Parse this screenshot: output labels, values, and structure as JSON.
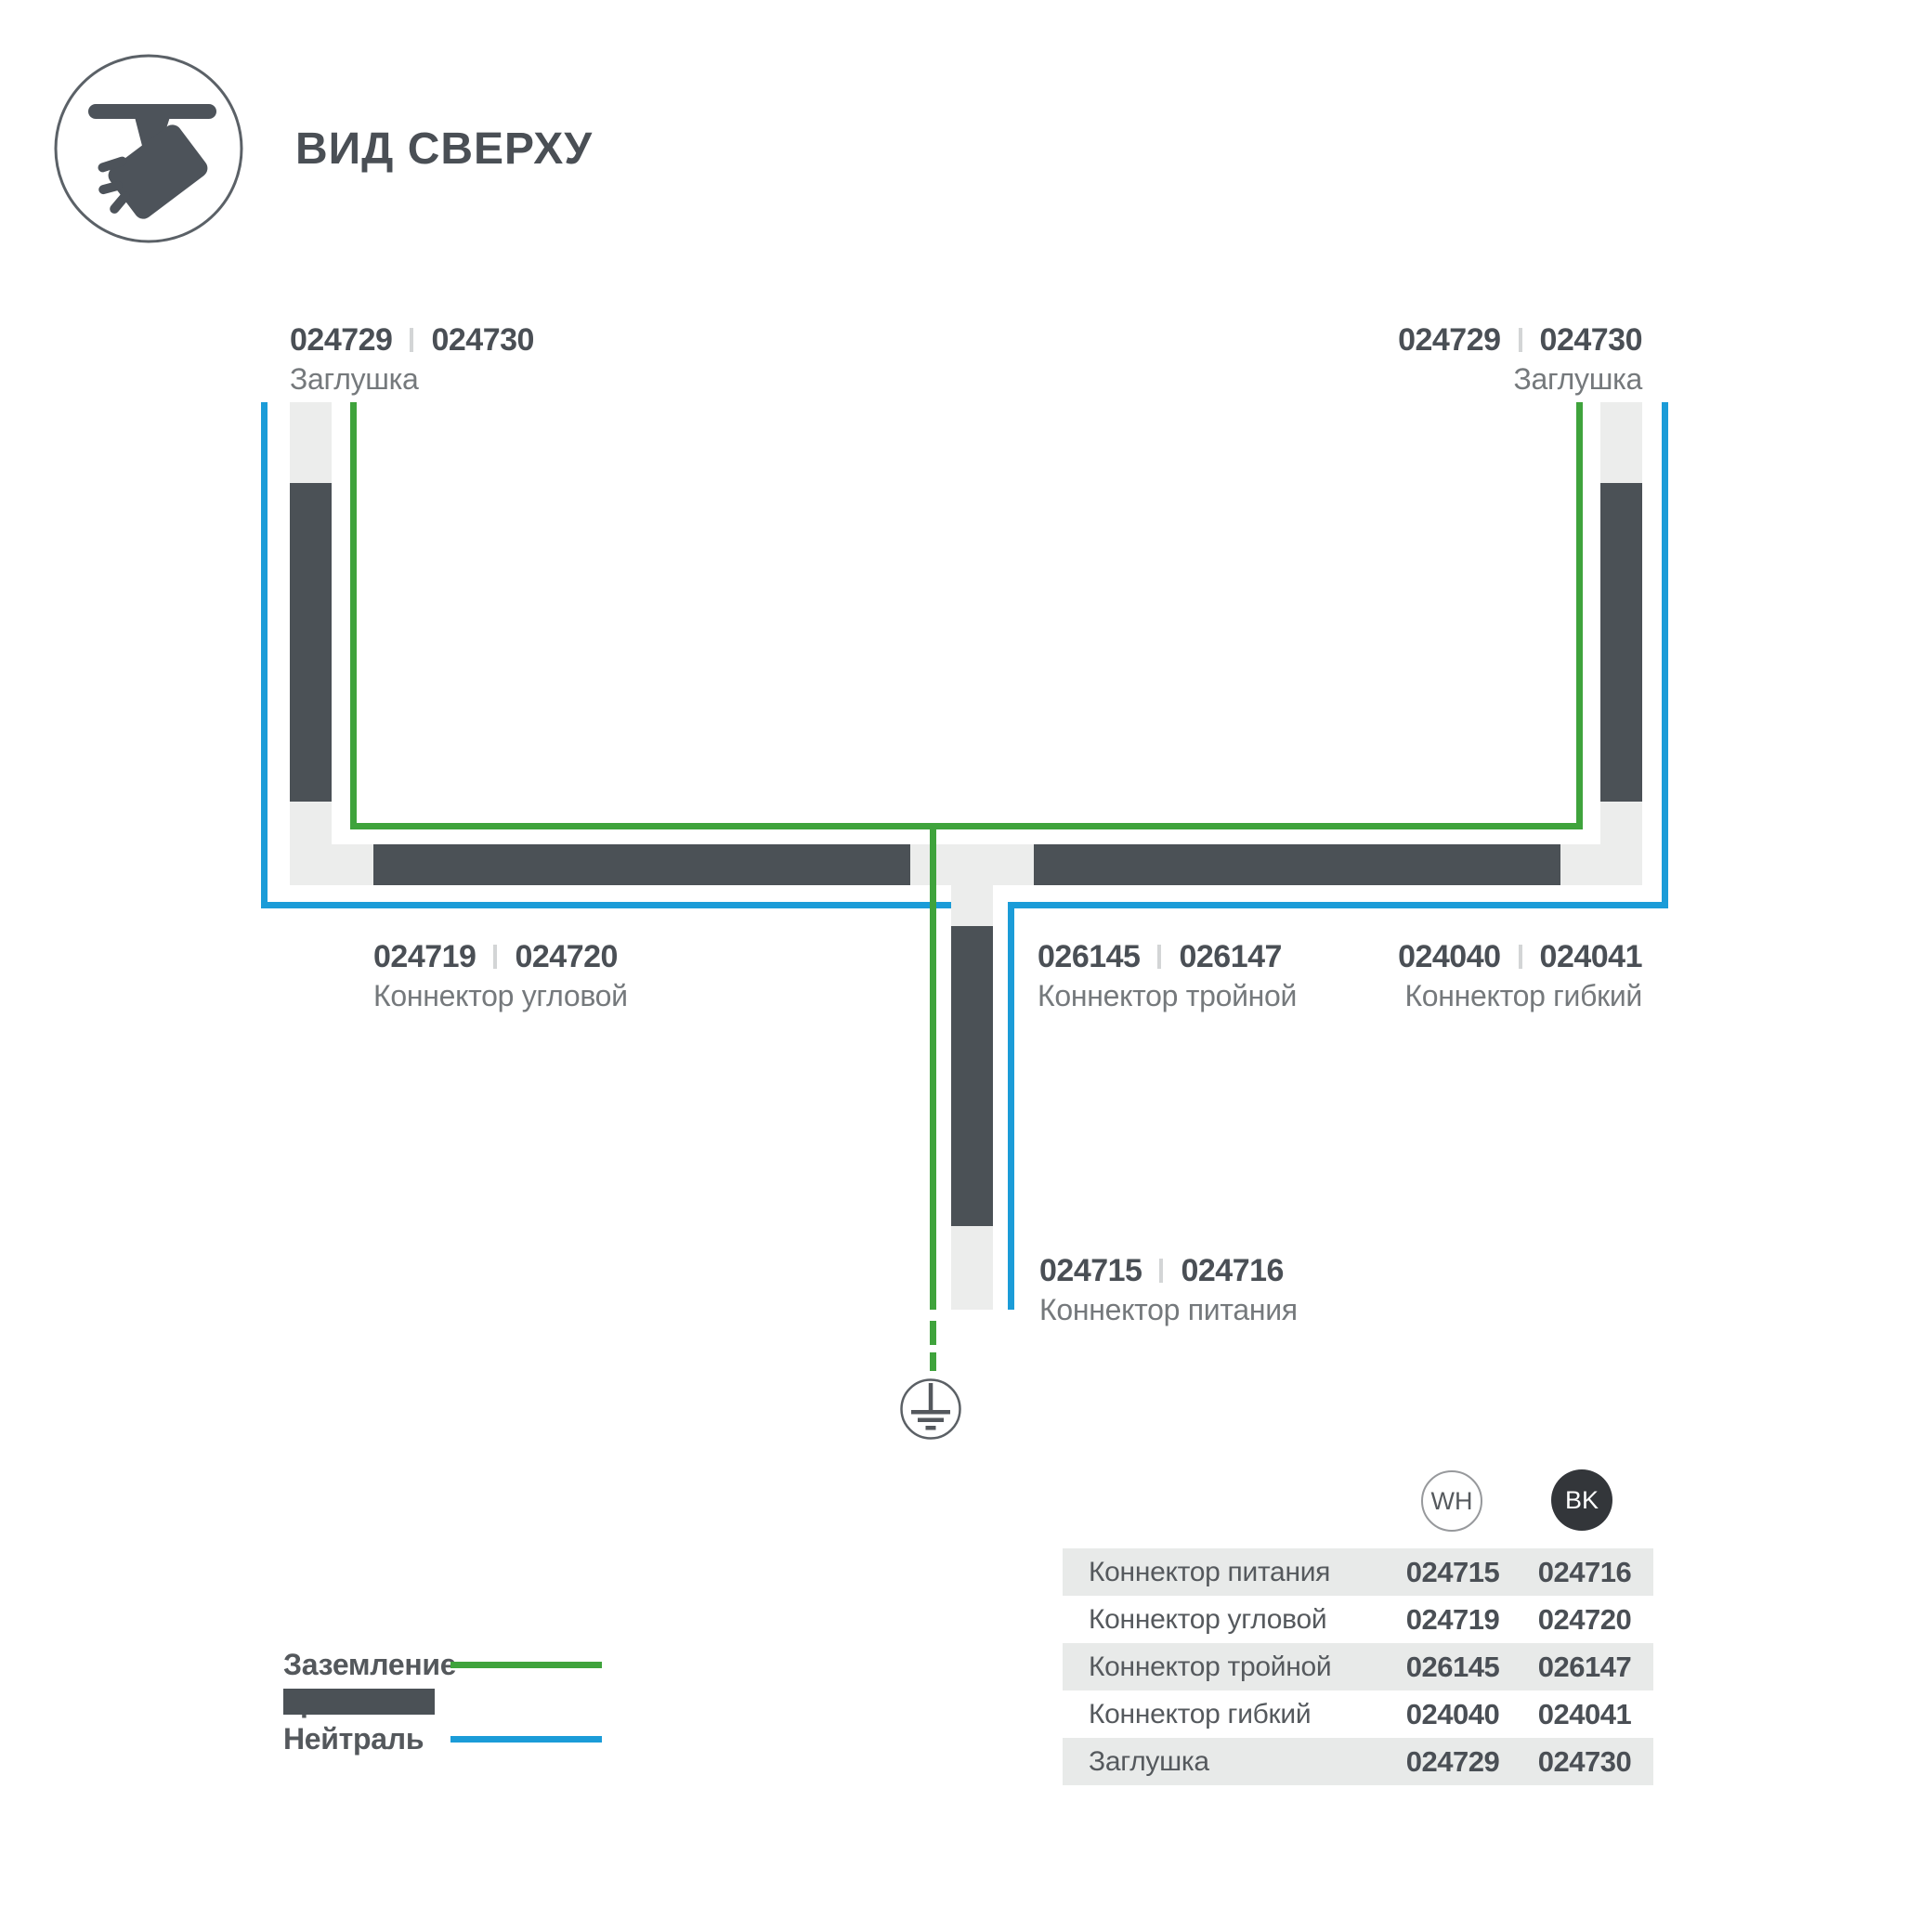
{
  "header": {
    "title": "ВИД СВЕРХУ"
  },
  "labels": {
    "cap_left": {
      "wh": "024729",
      "bk": "024730",
      "name": "Заглушка"
    },
    "cap_right": {
      "wh": "024729",
      "bk": "024730",
      "name": "Заглушка"
    },
    "corner": {
      "wh": "024719",
      "bk": "024720",
      "name": "Коннектор угловой"
    },
    "triple": {
      "wh": "026145",
      "bk": "026147",
      "name": "Коннектор тройной"
    },
    "flexible": {
      "wh": "024040",
      "bk": "024041",
      "name": "Коннектор гибкий"
    },
    "power": {
      "wh": "024715",
      "bk": "024716",
      "name": "Коннектор питания"
    }
  },
  "legend": {
    "ground": "Заземление",
    "track": "Трек",
    "neutral": "Нейтраль"
  },
  "table": {
    "columns": {
      "wh": "WH",
      "bk": "BK"
    },
    "rows": [
      {
        "name": "Коннектор питания",
        "wh": "024715",
        "bk": "024716"
      },
      {
        "name": "Коннектор угловой",
        "wh": "024719",
        "bk": "024720"
      },
      {
        "name": "Коннектор тройной",
        "wh": "026145",
        "bk": "026147"
      },
      {
        "name": "Коннектор гибкий",
        "wh": "024040",
        "bk": "024041"
      },
      {
        "name": "Заглушка",
        "wh": "024729",
        "bk": "024730"
      }
    ]
  },
  "colors": {
    "track": "#4b5156",
    "ground": "#3fa33c",
    "neutral": "#1b9cd8",
    "housing": "#ecedec",
    "row_gray": "#e8eae9",
    "bk_badge": "#33363a"
  }
}
